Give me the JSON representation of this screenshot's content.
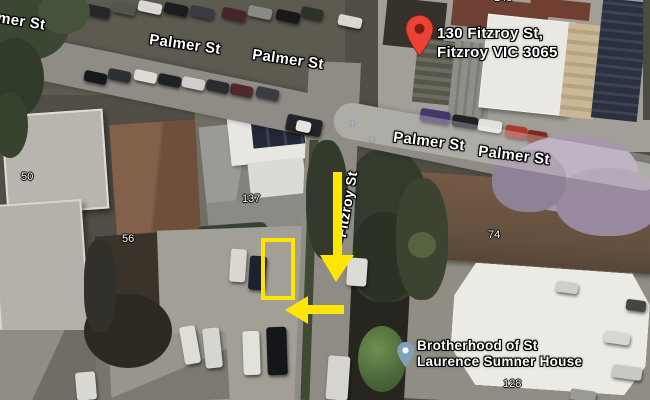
{
  "streets": {
    "palmer_clipped": "mer St",
    "palmer_nw": "Palmer St",
    "palmer_n": "Palmer St",
    "palmer_e1": "Palmer St",
    "palmer_e2": "Palmer St",
    "fitzroy": "Fitzroy St"
  },
  "parcels": {
    "p50": "50",
    "p56": "56",
    "p137": "137",
    "p74": "74",
    "p128": "128",
    "p148": "148"
  },
  "destination_pin": {
    "line1": "130 Fitzroy St,",
    "line2": "Fitzroy VIC 3065",
    "color": "#ea4335"
  },
  "poi_pin": {
    "line1": "Brotherhood of St",
    "line2": "Laurence Sumner House",
    "color": "#7fa2ba"
  },
  "road_markers": {
    "plus_a": "+",
    "plus_b": "+"
  },
  "annotations": {
    "highlight_color": "#ffe600",
    "shapes": [
      "parking-spot-rectangle",
      "down-arrow",
      "left-turn-arrow"
    ]
  }
}
